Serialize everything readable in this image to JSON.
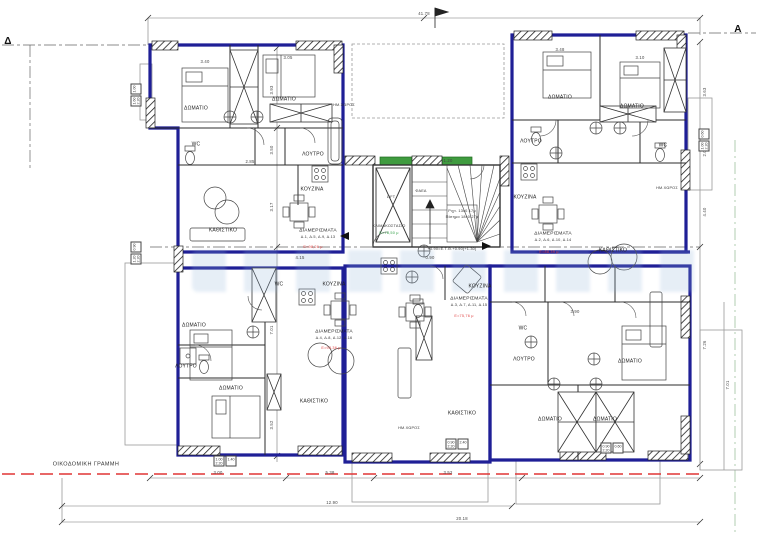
{
  "section_markers": {
    "left": "Δ",
    "right": "A"
  },
  "building_line_label": "ΟΙΚΟΔΟΜΙΚΗ ΓΡΑΜΜΗ",
  "room_labels": {
    "bedroom": "ΔΩΜΑΤΙΟ",
    "living": "ΚΑΘΙΣΤΙΚΟ",
    "kitchen": "ΚΟΥΖΙΝΑ",
    "bath": "ΛΟΥΤΡΟ",
    "wc": "WC",
    "semi_open": "ΗΜ.ΧΩΡΟΣ"
  },
  "core": {
    "lift": "LIFT",
    "shaft": "ΦΑΕΑ",
    "stair": "ΚΛΙΜΑΚΟΣΤΑΣΙΟ",
    "stair_area": "Ε=78,50 μ",
    "note1": "Ριχτ. 13x0.17μ",
    "note2": "Πάτημα 18x0.27μ",
    "level": "+0.90=Ε.Τ.Θ.+0.90(+1.30)"
  },
  "apartments": [
    {
      "title": "ΔΙΑΜΕΡΙΣΜΑΤΑ",
      "units": "Δ.1, Δ.5, Δ.9, Δ.13",
      "area": "Ε=98,26 μ"
    },
    {
      "title": "ΔΙΑΜΕΡΙΣΜΑΤΑ",
      "units": "Δ.2, Δ.6, Δ.10, Δ.14",
      "area": "Ε=88,39 μ"
    },
    {
      "title": "ΔΙΑΜΕΡΙΣΜΑΤΑ",
      "units": "Δ.3, Δ.7, Δ.11, Δ.15",
      "area": "Ε=75,76 μ"
    },
    {
      "title": "ΔΙΑΜΕΡΙΣΜΑΤΑ",
      "units": "Δ.4, Δ.8, Δ.12, Δ.16",
      "area": "Ε=93,36 μ"
    }
  ],
  "dims": {
    "top": "41.78",
    "b1": "3.00",
    "b2": "5.38",
    "b3": "3.52",
    "b4": "12.90",
    "b5": "20.18",
    "l1": "3.93",
    "l2": "3.50",
    "l3": "3.17",
    "l4": "7.01",
    "l5": "3.52",
    "r1": "3.63",
    "r2": "2.03",
    "r3": "4.40",
    "r4": "7.26",
    "r5": "7.01",
    "i1": "3.40",
    "i2": "3.05",
    "i3": "3.48",
    "i4": "3.10",
    "i5": "2.85",
    "i6": "1.20",
    "i7": "4.15",
    "i8": "3.90",
    "i9": "0.90"
  },
  "window_tags": [
    {
      "w": "1.00",
      "h": "2.20",
      "s": "1.40"
    },
    {
      "w": "0.90",
      "h": "2.20",
      "s": "2.40"
    },
    {
      "w": "0.90",
      "h": "2.20",
      "s": "0.60"
    },
    {
      "w": "1.60",
      "h": "2.20",
      "s": "1.00"
    },
    {
      "w": "1.20",
      "h": "2.20",
      "s": "0.90"
    },
    {
      "w": "1.00",
      "h": "2.20",
      "s": "0.60"
    }
  ]
}
